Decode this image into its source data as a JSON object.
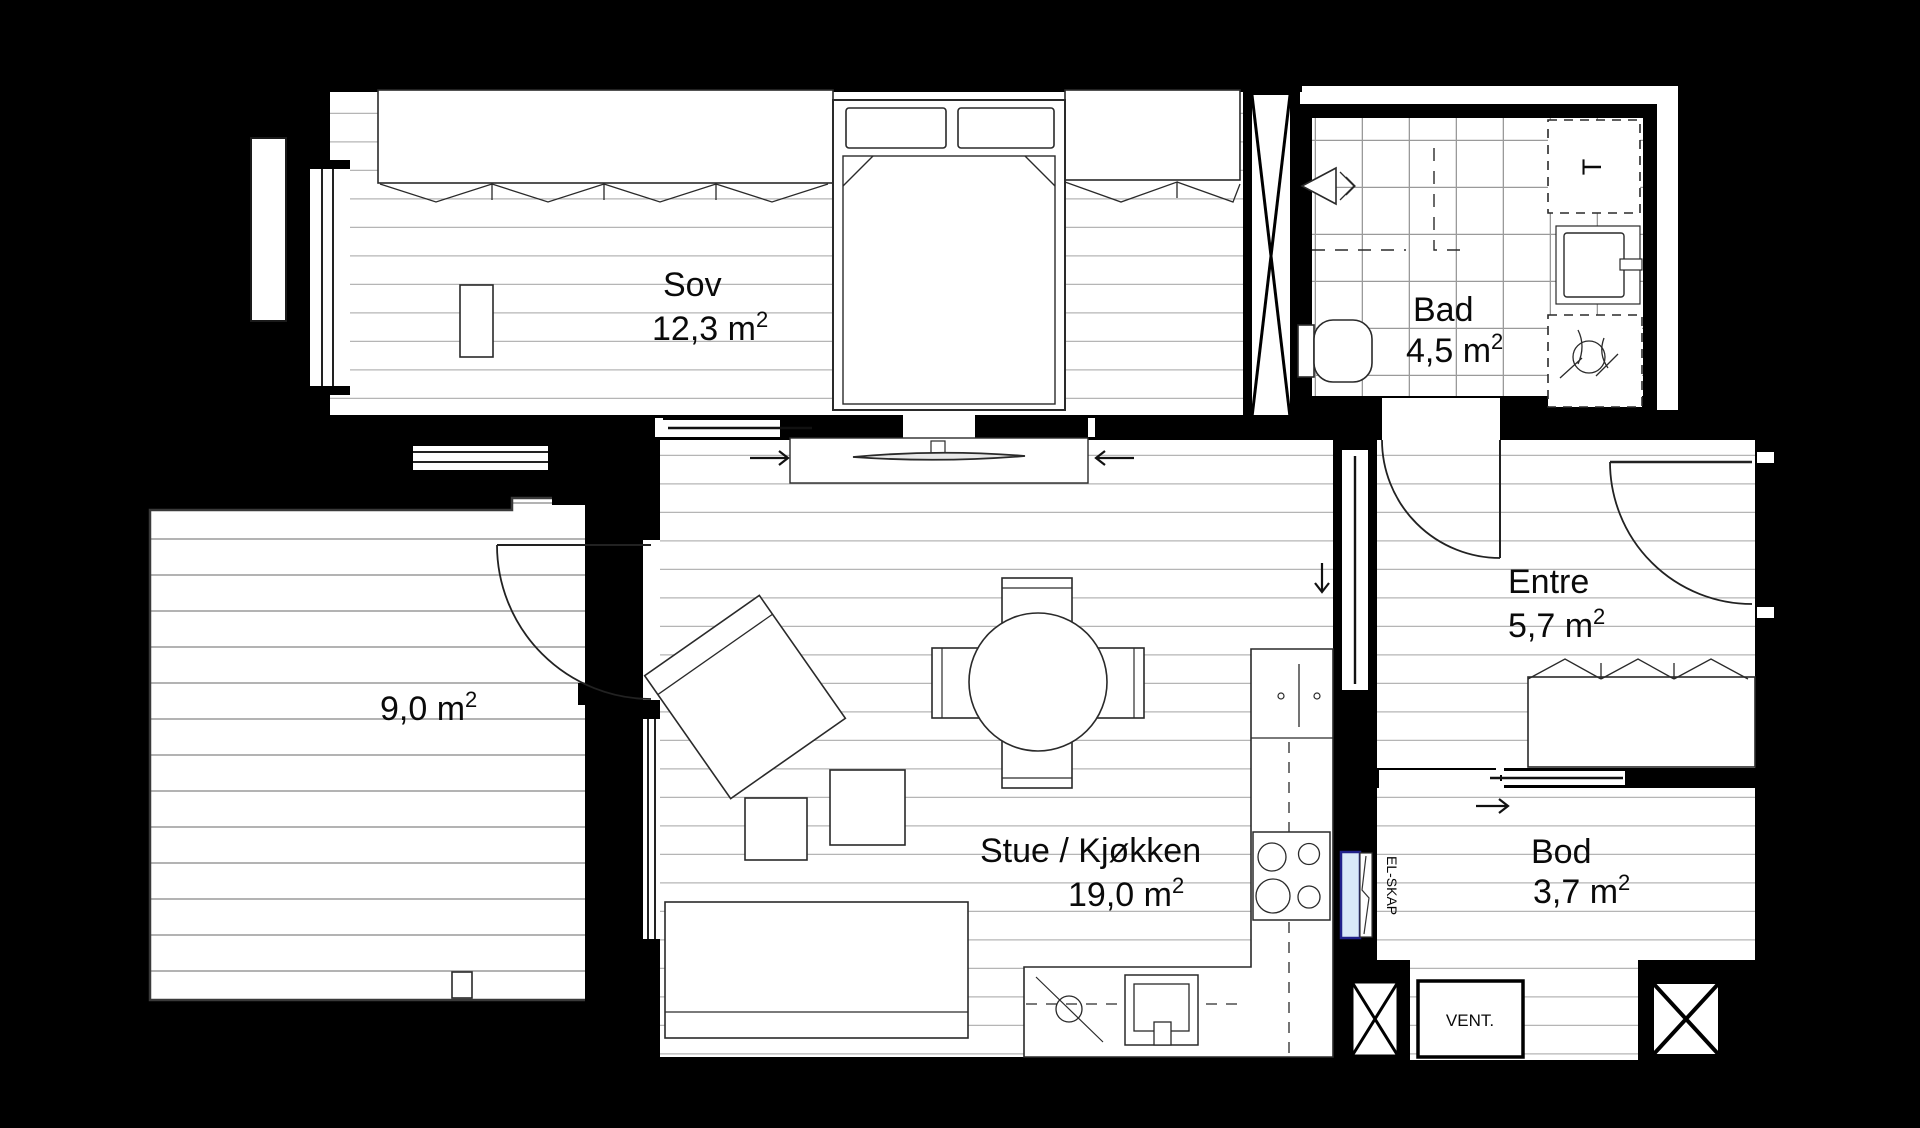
{
  "plan": {
    "title": "apartment-floor-plan",
    "rooms": [
      {
        "id": "sov",
        "label": "Sov",
        "area": "12,3 m",
        "sup": "2"
      },
      {
        "id": "bad",
        "label": "Bad",
        "area": "4,5 m",
        "sup": "2"
      },
      {
        "id": "balkong",
        "label": "",
        "area": "9,0 m",
        "sup": "2"
      },
      {
        "id": "stue",
        "label": "Stue / Kjøkken",
        "area": "19,0 m",
        "sup": "2"
      },
      {
        "id": "entre",
        "label": "Entre",
        "area": "5,7 m",
        "sup": "2"
      },
      {
        "id": "bod",
        "label": "Bod",
        "area": "3,7 m",
        "sup": "2"
      }
    ],
    "annotations": {
      "vent": "VENT.",
      "el_skap": "EL-SKAP",
      "washer": "T"
    },
    "colors": {
      "background": "#000000",
      "floor": "#ffffff",
      "wall": "#000000",
      "floor_line": "#b5b5b5",
      "deck_line": "#a8a8a8",
      "tile_line": "#9a9a9a",
      "el_skap_fill": "#d9e8f8",
      "el_skap_border": "#20208a"
    }
  }
}
